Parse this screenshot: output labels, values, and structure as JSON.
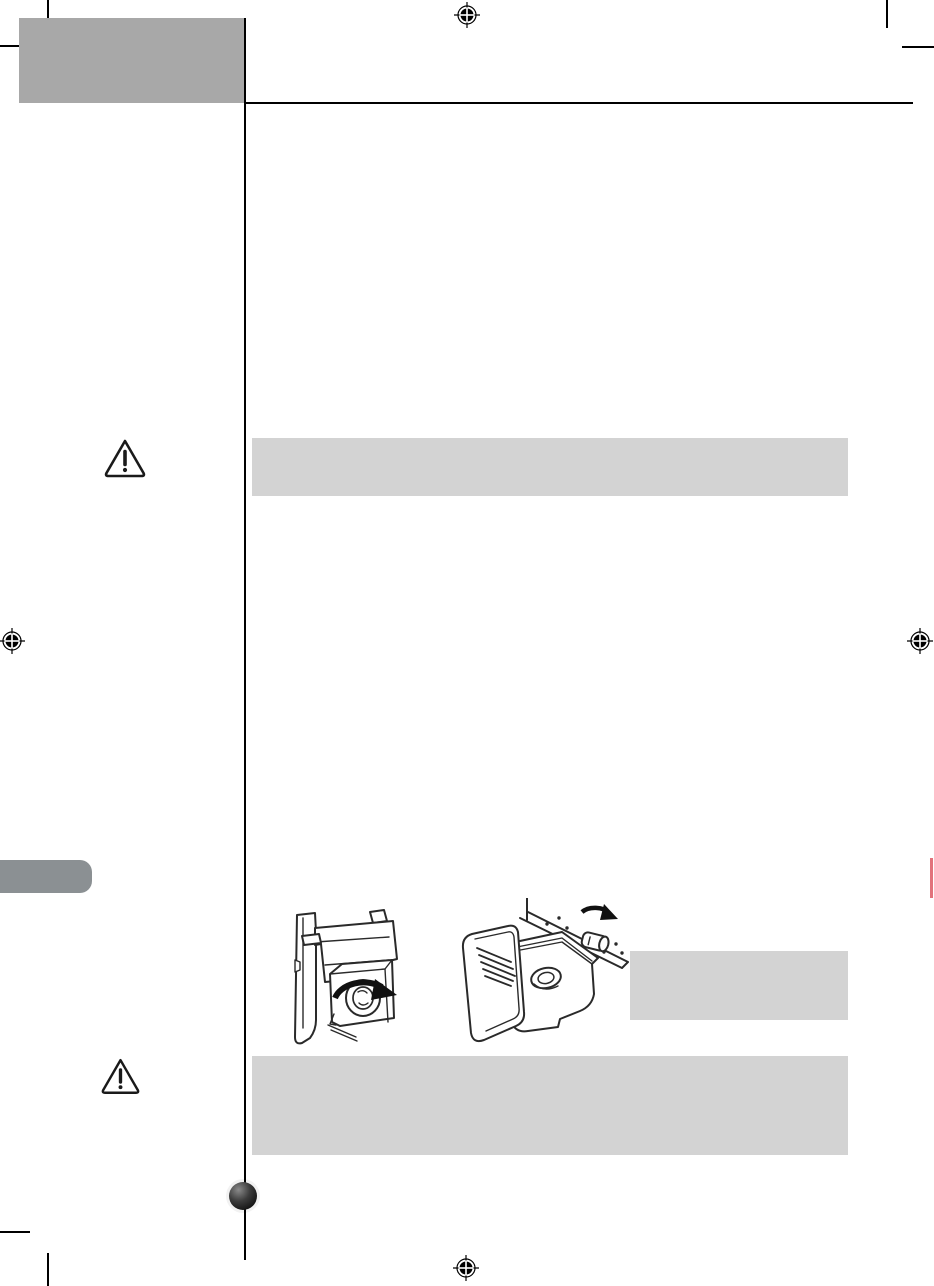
{
  "page": {
    "kind": "document-proof-page",
    "background_color": "#ffffff"
  },
  "colors": {
    "header_block": "#a8a8a8",
    "section_tab": "#8b9093",
    "callout_box": "#d3d3d3",
    "rule": "#000000",
    "red_edge_mark": "#e2737c"
  },
  "header": {
    "title_text": ""
  },
  "callouts": {
    "upper_note": {
      "text": ""
    },
    "side_note": {
      "text": ""
    },
    "lower_note": {
      "text": ""
    }
  },
  "icons": {
    "registration_marks": [
      "top-center",
      "left-middle",
      "right-middle",
      "bottom-center"
    ],
    "warning_triangles": [
      "upper-caution",
      "lower-caution"
    ],
    "illustrations": [
      "ice-maker-unit",
      "ice-bin-with-auger"
    ],
    "page_bullet": "page-number-dot"
  }
}
